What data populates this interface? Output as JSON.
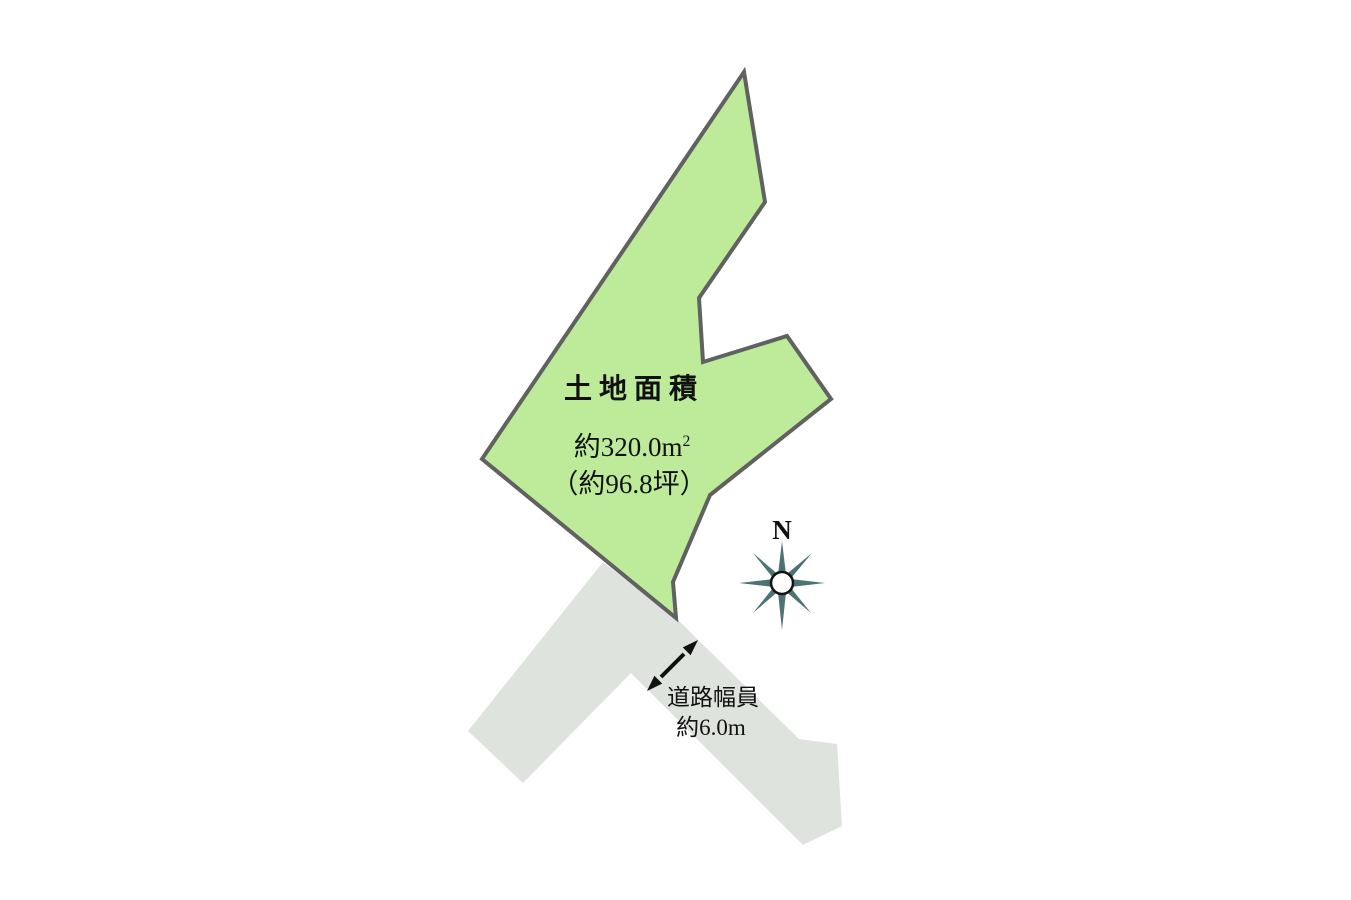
{
  "diagram": {
    "plot": {
      "title": "土地面積",
      "area_value": "約320.0",
      "area_unit": "m",
      "area_unit_exponent": "2",
      "area_tsubo": "（約96.8坪）",
      "fill": "#bdeb9a",
      "outline": "#616161"
    },
    "road": {
      "width_label": "道路幅員",
      "width_value": "約6.0m",
      "fill": "#dfe3dd"
    },
    "compass": {
      "label": "N",
      "color": "#4e7374"
    },
    "arrow_color": "#111111"
  }
}
